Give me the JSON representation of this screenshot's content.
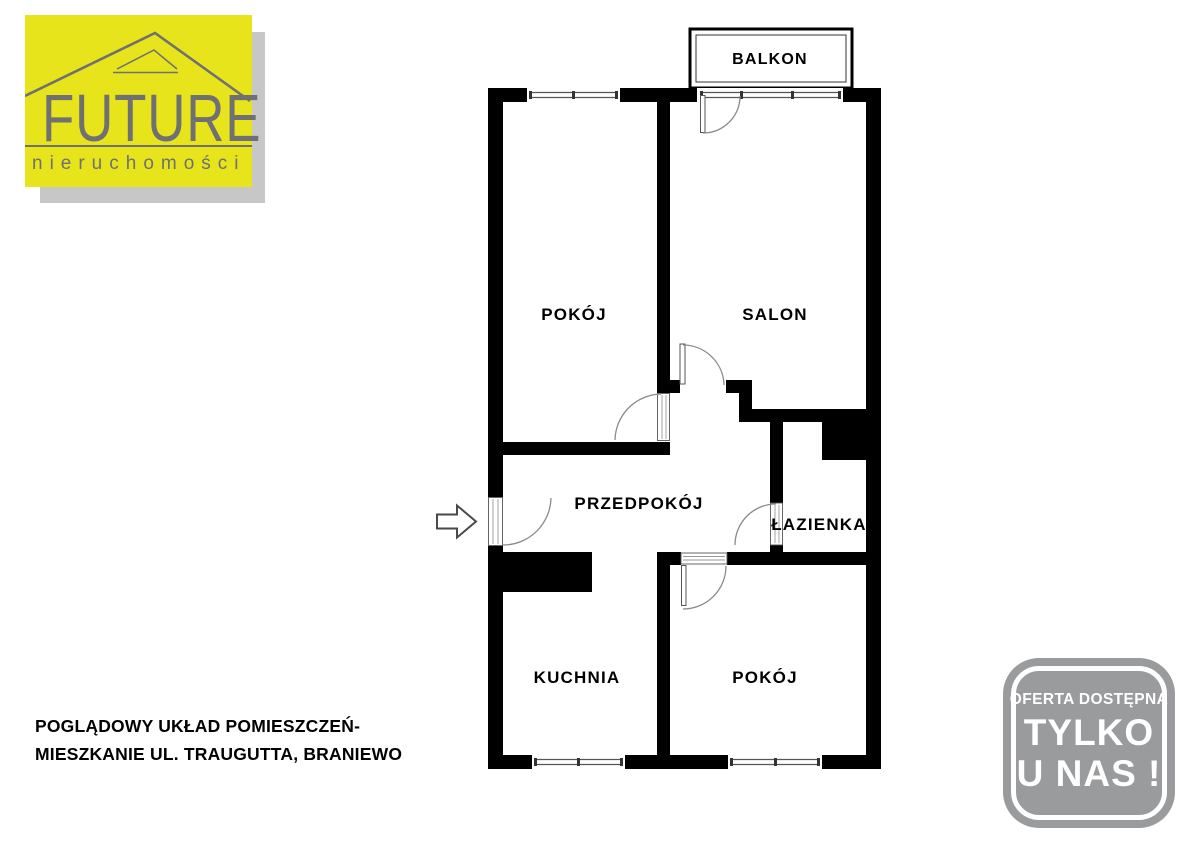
{
  "theme": {
    "logo-yellow": "#E7E41C",
    "logo-gray": "#6E7072",
    "logo-shadow": "#C7C7C7",
    "badge-gray": "#9A9B9D",
    "wall-color": "#000000",
    "line-color": "#8A8A8A",
    "text-color": "#000000"
  },
  "logo": {
    "title": "FUTURE",
    "subtitle": "nieruchomości"
  },
  "icons": {
    "roof": "roof-icon",
    "entrance_arrow": "entrance-arrow-icon"
  },
  "floorplan": {
    "labels": {
      "balkon": "BALKON",
      "pokoj_top": "POKÓJ",
      "salon": "SALON",
      "przedpokoj": "PRZEDPOKÓJ",
      "lazienka": "ŁAZIENKA",
      "kuchnia": "KUCHNIA",
      "pokoj_bottom": "POKÓJ"
    }
  },
  "caption": {
    "line1": "POGLĄDOWY UKŁAD POMIESZCZEŃ-",
    "line2": "MIESZKANIE UL. TRAUGUTTA, BRANIEWO"
  },
  "badge": {
    "line1": "OFERTA DOSTĘPNA",
    "line2": "TYLKO",
    "line3": "U NAS !"
  }
}
